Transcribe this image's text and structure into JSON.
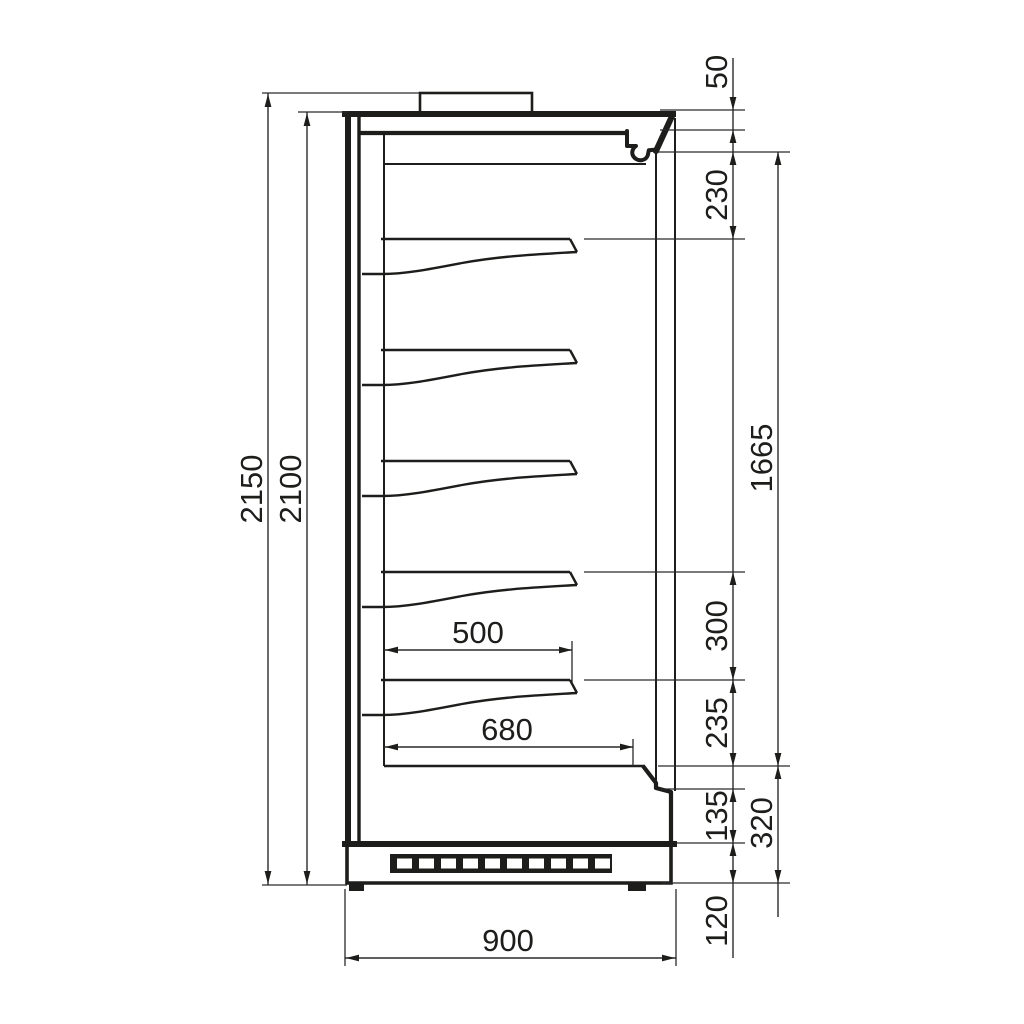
{
  "drawing": {
    "description": "Side section view of open-front refrigerated multideck display case with 5 shelves and dimension callouts (mm)",
    "dims": {
      "overall_height": "2150",
      "case_height": "2100",
      "top_clearance": "50",
      "top_to_first_shelf": "230",
      "usable_height": "1665",
      "shelf_spacing": "300",
      "last_shelf_to_deck": "235",
      "lower_front_height": "135",
      "base_section_height": "320",
      "plinth_height": "120",
      "shelf_depth": "500",
      "deck_depth": "680",
      "overall_depth": "900"
    }
  }
}
